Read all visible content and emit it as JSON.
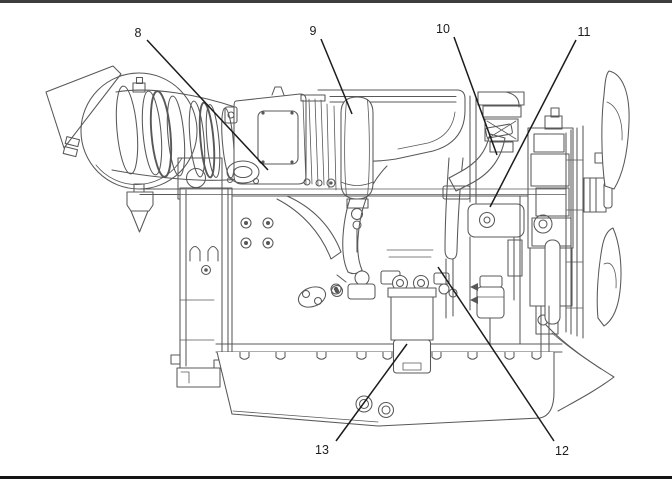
{
  "figure": {
    "kind": "engine-side-view-line-illustration",
    "description": "Technical parts-identification illustration of a diesel engine, right side view, with numbered callouts",
    "width": 672,
    "height": 482,
    "background": "#ffffff",
    "art_color": "#585858",
    "callout_color": "#1c1c1c",
    "top_border_color": "#3d3d3d",
    "bottom_border_color": "#141414"
  },
  "callouts": [
    {
      "label": "8",
      "text_x": 138,
      "text_y": 37,
      "line": {
        "x1": 147,
        "y1": 40,
        "x2": 268,
        "y2": 170
      }
    },
    {
      "label": "9",
      "text_x": 313,
      "text_y": 35,
      "line": {
        "x1": 321,
        "y1": 39,
        "x2": 352,
        "y2": 114
      }
    },
    {
      "label": "10",
      "text_x": 443,
      "text_y": 33,
      "line": {
        "x1": 454,
        "y1": 37,
        "x2": 497,
        "y2": 155
      }
    },
    {
      "label": "11",
      "text_x": 584,
      "text_y": 36,
      "line": {
        "x1": 576,
        "y1": 40,
        "x2": 490,
        "y2": 207
      }
    },
    {
      "label": "12",
      "text_x": 562,
      "text_y": 455,
      "line": {
        "x1": 554,
        "y1": 441,
        "x2": 438,
        "y2": 267
      }
    },
    {
      "label": "13",
      "text_x": 322,
      "text_y": 454,
      "line": {
        "x1": 336,
        "y1": 441,
        "x2": 407,
        "y2": 344
      }
    }
  ]
}
